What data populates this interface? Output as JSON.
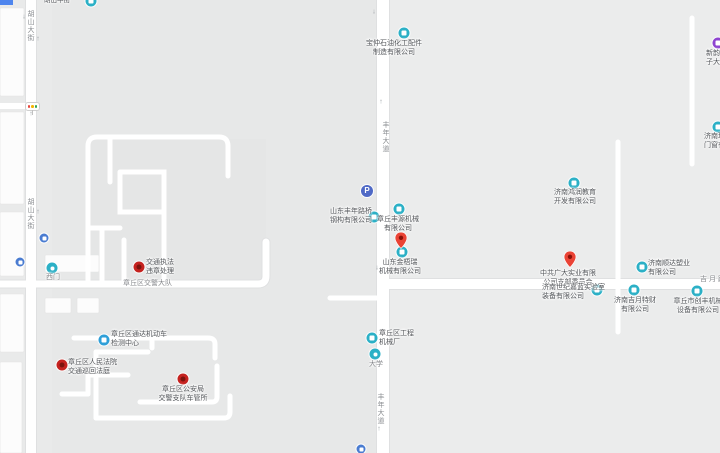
{
  "glyphs": {
    "up_arrow": "↑",
    "down_arrow": "↓",
    "parking": "P"
  },
  "road_labels": {
    "hushan_top": "胡山大街",
    "hushan_mid": "胡山大街",
    "fengnian_top": "丰年大道",
    "fengnian_bottom": "丰年大道",
    "jiyue": "吉月路",
    "top_edge_partial": "胡山中街"
  },
  "place_labels": {
    "traffic_brigade": "章丘区交警大队",
    "west_gate": "西门",
    "university": "大学"
  },
  "pois": [
    {
      "id": "baozhong",
      "lines": [
        "宝仲石油化工配件",
        "制造有限公司"
      ]
    },
    {
      "id": "xinyun",
      "lines": [
        "新韵电",
        "子大厦"
      ]
    },
    {
      "id": "lixiang",
      "lines": [
        "济南理",
        "门窗有限"
      ]
    },
    {
      "id": "hongrun",
      "lines": [
        "济南鸿润教育",
        "开发有限公司"
      ]
    },
    {
      "id": "fengnian-luqiao",
      "lines": [
        "山东丰年路桥",
        "钢构有限公司"
      ]
    },
    {
      "id": "fengyuan",
      "lines": [
        "章丘丰源机械",
        "有限公司"
      ]
    },
    {
      "id": "jinwurui",
      "lines": [
        "山东金梧瑞",
        "机械有限公司"
      ]
    },
    {
      "id": "guangda",
      "lines": [
        "中共广大实业有限",
        "公司支部委员会"
      ]
    },
    {
      "id": "shunda",
      "lines": [
        "济南顺达塑业",
        "有限公司"
      ]
    },
    {
      "id": "shiji-jialan",
      "lines": [
        "济南世纪嘉蓝实验室",
        "装备有限公司"
      ]
    },
    {
      "id": "jiyue-tecai",
      "lines": [
        "济南吉月特财",
        "有限公司"
      ]
    },
    {
      "id": "chuangfeng",
      "lines": [
        "章丘市创丰机械",
        "设备有限公司"
      ]
    },
    {
      "id": "gongcheng",
      "lines": [
        "章丘区工程",
        "机械厂"
      ]
    },
    {
      "id": "tongda",
      "lines": [
        "章丘区通达机动车",
        "检测中心"
      ]
    },
    {
      "id": "renmin-fayuan",
      "lines": [
        "章丘区人民法院",
        "交通巡回法庭"
      ]
    },
    {
      "id": "gongan",
      "lines": [
        "章丘区公安局",
        "交警支队车管所"
      ]
    },
    {
      "id": "zhifa",
      "lines": [
        "交通执法",
        "违章处理"
      ]
    }
  ],
  "colors": {
    "poi_teal": "#2bb0c6",
    "poi_red": "#c5221f",
    "poi_blue": "#4a7cd1",
    "poi_purple": "#8e44d0",
    "pin_red": "#ea4335",
    "road": "#ffffff",
    "background": "#e9eaea"
  }
}
